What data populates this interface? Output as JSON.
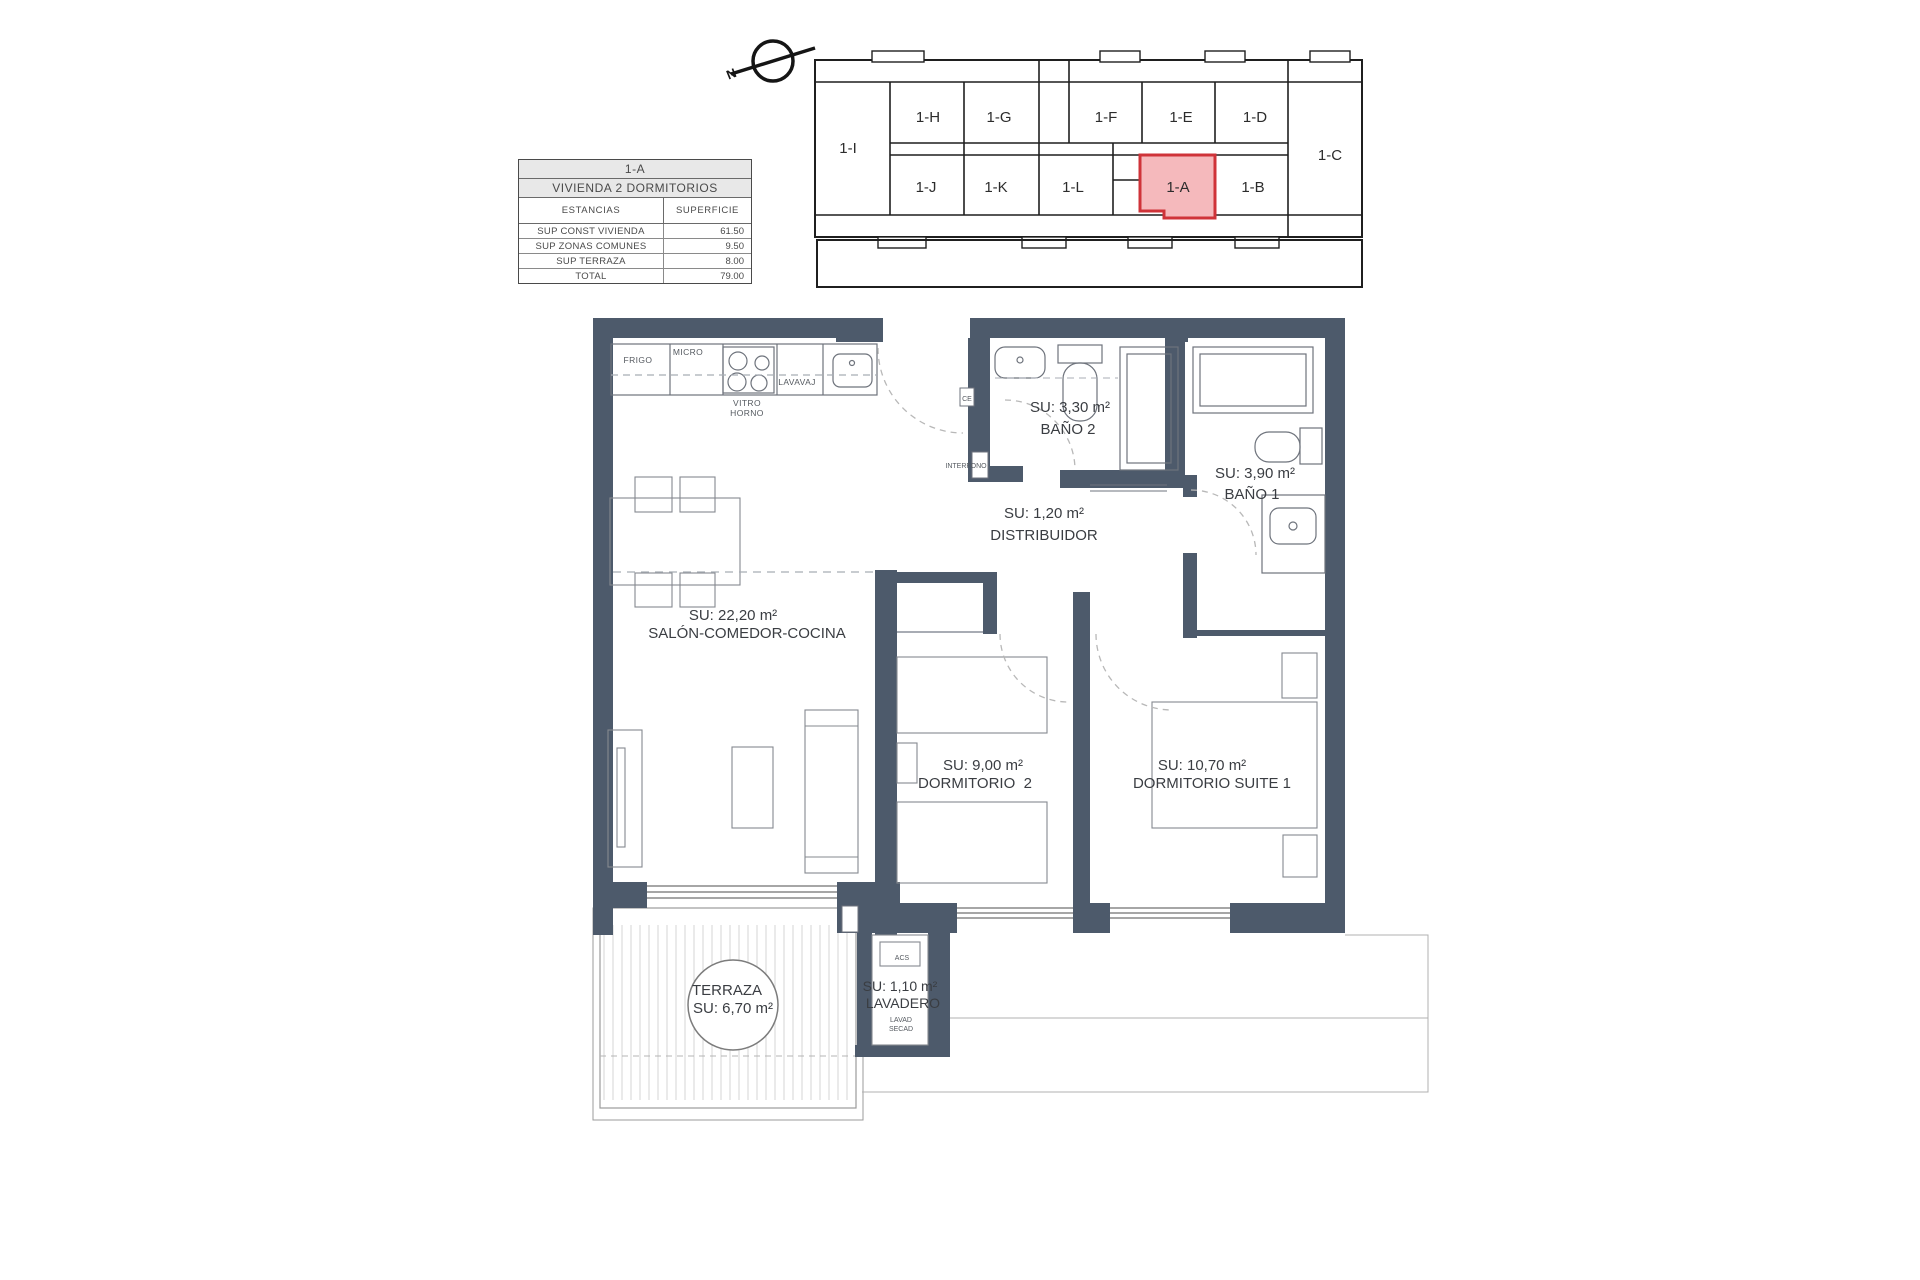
{
  "colors": {
    "wall": "#4d5a6b",
    "highlight_fill": "#f5b9bc",
    "highlight_stroke": "#cf3339"
  },
  "compass": {
    "north_label": "N"
  },
  "key_plan": {
    "highlighted_unit": "1-A",
    "units": [
      {
        "label": "1-I"
      },
      {
        "label": "1-H"
      },
      {
        "label": "1-G"
      },
      {
        "label": "1-F"
      },
      {
        "label": "1-E"
      },
      {
        "label": "1-D"
      },
      {
        "label": "1-C"
      },
      {
        "label": "1-J"
      },
      {
        "label": "1-K"
      },
      {
        "label": "1-L"
      },
      {
        "label": "1-A"
      },
      {
        "label": "1-B"
      }
    ]
  },
  "info_table": {
    "title": "1-A",
    "subtitle": "VIVIENDA 2 DORMITORIOS",
    "col_headers": [
      "ESTANCIAS",
      "SUPERFICIE"
    ],
    "rows": [
      {
        "label": "SUP CONST VIVIENDA",
        "value": "61.50"
      },
      {
        "label": "SUP ZONAS COMUNES",
        "value": "9.50"
      },
      {
        "label": "SUP TERRAZA",
        "value": "8.00"
      },
      {
        "label": "TOTAL",
        "value": "79.00"
      }
    ]
  },
  "rooms": {
    "salon": {
      "area_label": "SU: 22,20 m²",
      "name": "SALÓN-COMEDOR-COCINA"
    },
    "bano2": {
      "area_label": "SU: 3,30 m²",
      "name": "BAÑO 2"
    },
    "bano1": {
      "area_label": "SU: 3,90 m²",
      "name": "BAÑO 1"
    },
    "distribuidor": {
      "area_label": "SU: 1,20 m²",
      "name": "DISTRIBUIDOR"
    },
    "dormitorio2": {
      "area_label": "SU: 9,00 m²",
      "name": "DORMITORIO  2"
    },
    "suite1": {
      "area_label": "SU: 10,70 m²",
      "name": "DORMITORIO SUITE 1"
    },
    "terraza": {
      "name": "TERRAZA",
      "area_label": "SU: 6,70 m²"
    },
    "lavadero": {
      "area_label": "SU: 1,10 m²",
      "name": "LAVADERO"
    }
  },
  "kitchen": {
    "frigo": "FRIGO",
    "micro": "MICRO",
    "vitro": "VITRO",
    "horno": "HORNO",
    "lavavaj": "LAVAVAJ"
  },
  "equipment": {
    "acs": "ACS",
    "lavad": "LAVAD",
    "secad": "SECAD",
    "ce": "CE",
    "interfono": "INTERFONO"
  }
}
